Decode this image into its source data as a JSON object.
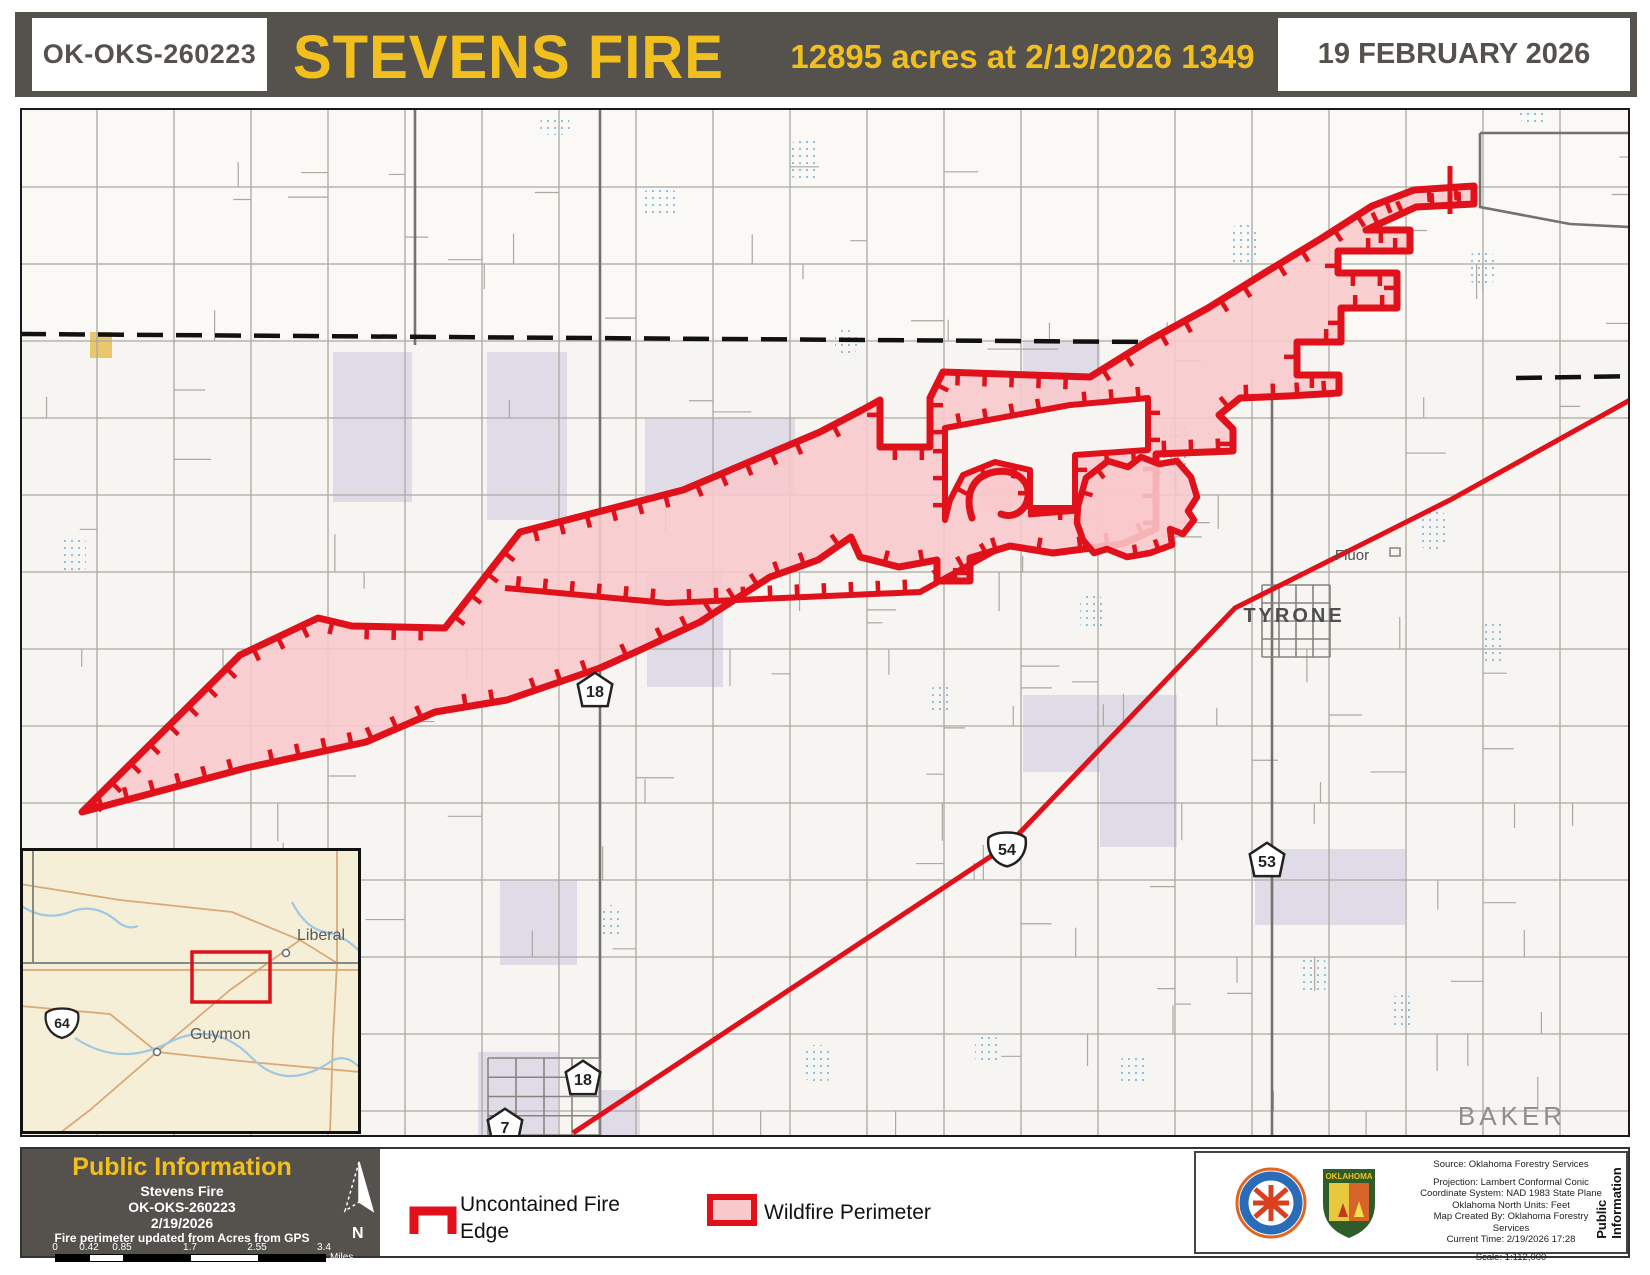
{
  "header": {
    "incident_id": "OK-OKS-260223",
    "title": "STEVENS FIRE",
    "acres_line": "12895 acres at 2/19/2026 1349",
    "date": "19 FEBRUARY 2026"
  },
  "colors": {
    "bar": "#55524E",
    "yellow": "#F2C01E",
    "fire_red": "#E0111A",
    "fire_pink": "#F8C8CB",
    "road": "#ABA8A2",
    "road_dark": "#75726E",
    "purple": "#CFCBE2",
    "water": "#6FB0D6",
    "inset_bg": "#F4EFD6",
    "tan": "#D9A977",
    "map_bg": "#F7F5F1",
    "kansas_bg": "#FAF9F6"
  },
  "map": {
    "labels": [
      {
        "text": "TYRONE",
        "x": 1294,
        "y": 622,
        "size": 20,
        "ls": 3,
        "color": "#4F4F4F",
        "bold": true
      },
      {
        "text": "Fluor",
        "x": 1352,
        "y": 560,
        "size": 15,
        "ls": 0,
        "color": "#4F4F4F",
        "bold": false
      },
      {
        "text": "BAKER",
        "x": 1512,
        "y": 1125,
        "size": 26,
        "ls": 4,
        "color": "#908E8A",
        "bold": false
      }
    ],
    "shields": [
      {
        "type": "state",
        "num": "18",
        "x": 595,
        "y": 690
      },
      {
        "type": "us",
        "num": "54",
        "x": 1007,
        "y": 848
      },
      {
        "type": "state",
        "num": "53",
        "x": 1267,
        "y": 860
      },
      {
        "type": "state",
        "num": "18",
        "x": 583,
        "y": 1078
      },
      {
        "type": "state",
        "num": "7",
        "x": 505,
        "y": 1126
      }
    ],
    "grid": {
      "vx": [
        97,
        174,
        251,
        328,
        405,
        482,
        559,
        636,
        713,
        790,
        867,
        944,
        1021,
        1098,
        1175,
        1252,
        1329,
        1406,
        1483,
        1560,
        1637
      ],
      "hy": [
        187,
        264,
        341,
        418,
        495,
        572,
        649,
        726,
        803,
        880,
        957,
        1034,
        1111
      ]
    },
    "dark_roads": [
      [
        [
          600,
          110
        ],
        [
          600,
          1135
        ]
      ],
      [
        [
          1272,
          380
        ],
        [
          1272,
          1135
        ]
      ],
      [
        [
          415,
          110
        ],
        [
          415,
          345
        ]
      ],
      [
        [
          1480,
          133
        ],
        [
          1648,
          133
        ]
      ],
      [
        [
          1480,
          133
        ],
        [
          1480,
          207
        ],
        [
          1570,
          224
        ],
        [
          1648,
          228
        ]
      ]
    ],
    "state_line": [
      [
        [
          20,
          334
        ],
        [
          1150,
          342
        ]
      ],
      [
        [
          1516,
          378
        ],
        [
          1642,
          376
        ]
      ]
    ],
    "purple_rects": [
      [
        333,
        352,
        79,
        150
      ],
      [
        487,
        352,
        80,
        168
      ],
      [
        645,
        418,
        150,
        76
      ],
      [
        647,
        572,
        76,
        115
      ],
      [
        1023,
        341,
        77,
        77
      ],
      [
        1023,
        695,
        154,
        77
      ],
      [
        1100,
        772,
        77,
        75
      ],
      [
        1255,
        849,
        150,
        76
      ],
      [
        500,
        880,
        77,
        85
      ],
      [
        478,
        1052,
        80,
        83
      ],
      [
        598,
        1090,
        42,
        45
      ]
    ],
    "yellow_rect": [
      90,
      332,
      22,
      26
    ],
    "water_spots": [
      [
        640,
        190,
        40,
        26
      ],
      [
        790,
        140,
        30,
        40
      ],
      [
        1230,
        225,
        26,
        40
      ],
      [
        540,
        115,
        30,
        20
      ],
      [
        1470,
        250,
        24,
        36
      ],
      [
        1520,
        105,
        26,
        20
      ],
      [
        60,
        535,
        26,
        40
      ],
      [
        1160,
        425,
        30,
        46
      ],
      [
        1420,
        510,
        26,
        40
      ],
      [
        1480,
        620,
        26,
        46
      ],
      [
        1080,
        595,
        24,
        36
      ],
      [
        930,
        685,
        22,
        30
      ],
      [
        255,
        950,
        24,
        40
      ],
      [
        600,
        905,
        22,
        34
      ],
      [
        805,
        1045,
        26,
        38
      ],
      [
        975,
        1035,
        24,
        30
      ],
      [
        1300,
        955,
        26,
        40
      ],
      [
        1390,
        995,
        24,
        34
      ],
      [
        1120,
        1055,
        26,
        30
      ],
      [
        835,
        330,
        22,
        26
      ]
    ],
    "highway54": [
      [
        1648,
        390
      ],
      [
        1450,
        500
      ],
      [
        1235,
        608
      ],
      [
        1008,
        845
      ],
      [
        573,
        1133
      ]
    ],
    "town_grids": [
      [
        1262,
        585,
        68,
        72
      ],
      [
        488,
        1058,
        112,
        77
      ]
    ],
    "fluor_site": [
      1390,
      548,
      10,
      8
    ],
    "fire": {
      "main": [
        [
          82,
          812
        ],
        [
          240,
          655
        ],
        [
          318,
          618
        ],
        [
          352,
          626
        ],
        [
          445,
          628
        ],
        [
          520,
          532
        ],
        [
          683,
          490
        ],
        [
          820,
          432
        ],
        [
          862,
          410
        ],
        [
          880,
          400
        ],
        [
          880,
          447
        ],
        [
          930,
          447
        ],
        [
          930,
          398
        ],
        [
          943,
          372
        ],
        [
          1090,
          377
        ],
        [
          1148,
          341
        ],
        [
          1208,
          308
        ],
        [
          1266,
          272
        ],
        [
          1322,
          238
        ],
        [
          1372,
          206
        ],
        [
          1414,
          190
        ],
        [
          1474,
          186
        ],
        [
          1474,
          204
        ],
        [
          1416,
          207
        ],
        [
          1366,
          230
        ],
        [
          1410,
          230
        ],
        [
          1410,
          251
        ],
        [
          1338,
          251
        ],
        [
          1338,
          273
        ],
        [
          1397,
          273
        ],
        [
          1397,
          308
        ],
        [
          1341,
          308
        ],
        [
          1341,
          342
        ],
        [
          1297,
          342
        ],
        [
          1297,
          375
        ],
        [
          1339,
          375
        ],
        [
          1339,
          393
        ],
        [
          1288,
          396
        ],
        [
          1240,
          398
        ],
        [
          1219,
          415
        ],
        [
          1233,
          429
        ],
        [
          1233,
          451
        ],
        [
          1156,
          454
        ],
        [
          1156,
          529
        ],
        [
          1122,
          544
        ],
        [
          1053,
          553
        ],
        [
          1010,
          546
        ],
        [
          970,
          558
        ],
        [
          970,
          581
        ],
        [
          937,
          581
        ],
        [
          937,
          560
        ],
        [
          899,
          567
        ],
        [
          860,
          557
        ],
        [
          851,
          537
        ],
        [
          818,
          560
        ],
        [
          770,
          577
        ],
        [
          700,
          622
        ],
        [
          640,
          650
        ],
        [
          600,
          668
        ],
        [
          507,
          700
        ],
        [
          435,
          712
        ],
        [
          366,
          742
        ],
        [
          246,
          768
        ]
      ],
      "notch": [
        [
          945,
          428
        ],
        [
          1070,
          405
        ],
        [
          1148,
          398
        ],
        [
          1148,
          450
        ],
        [
          1075,
          455
        ],
        [
          1075,
          508
        ],
        [
          1030,
          508
        ],
        [
          1030,
          470
        ],
        [
          995,
          462
        ],
        [
          963,
          475
        ],
        [
          950,
          500
        ],
        [
          945,
          520
        ]
      ],
      "east_blob": [
        [
          1078,
          506
        ],
        [
          1086,
          478
        ],
        [
          1108,
          461
        ],
        [
          1128,
          467
        ],
        [
          1141,
          457
        ],
        [
          1159,
          464
        ],
        [
          1177,
          461
        ],
        [
          1191,
          477
        ],
        [
          1197,
          497
        ],
        [
          1188,
          511
        ],
        [
          1194,
          520
        ],
        [
          1183,
          534
        ],
        [
          1170,
          529
        ],
        [
          1172,
          545
        ],
        [
          1150,
          553
        ],
        [
          1127,
          557
        ],
        [
          1107,
          549
        ],
        [
          1094,
          553
        ],
        [
          1083,
          540
        ],
        [
          1077,
          523
        ]
      ],
      "inner_line": [
        [
          1000,
          548
        ],
        [
          920,
          592
        ],
        [
          667,
          603
        ],
        [
          505,
          588
        ]
      ],
      "hook_path": "M 972,518 C 964,494 973,476 994,472 C 1016,468 1030,481 1028,497 C 1026,511 1013,519 1001,514",
      "hook_center": [
        998,
        495
      ],
      "connector": [
        [
          1028,
          514
        ],
        [
          1078,
          510
        ]
      ],
      "tip_cross": [
        [
          1450,
          166
        ],
        [
          1450,
          214
        ]
      ]
    }
  },
  "inset": {
    "towns": [
      {
        "name": "Liberal",
        "x": 286,
        "y": 953,
        "lx": 297,
        "ly": 940
      },
      {
        "name": "Guymon",
        "x": 157,
        "y": 1052,
        "lx": 190,
        "ly": 1039
      }
    ],
    "shield": {
      "num": "64",
      "x": 62,
      "y": 1022
    },
    "extent_rect": [
      192,
      952,
      78,
      50
    ],
    "rivers": [
      "M 20,905 Q 45,922 70,912 Q 95,902 118,922 Q 128,930 138,926",
      "M 292,902 Q 305,928 325,932 Q 345,936 358,950",
      "M 75,1038 Q 120,1068 170,1042 Q 215,1020 252,1058 Q 285,1092 330,1062 Q 345,1052 360,1068"
    ],
    "tan_roads": [
      [
        [
          20,
          884
        ],
        [
          120,
          900
        ],
        [
          232,
          912
        ],
        [
          300,
          940
        ],
        [
          337,
          963
        ]
      ],
      [
        [
          300,
          940
        ],
        [
          230,
          990
        ],
        [
          157,
          1052
        ],
        [
          90,
          1110
        ],
        [
          60,
          1133
        ]
      ],
      [
        [
          20,
          1006
        ],
        [
          110,
          1014
        ],
        [
          157,
          1052
        ],
        [
          250,
          1062
        ],
        [
          360,
          1072
        ]
      ],
      [
        [
          337,
          848
        ],
        [
          337,
          963
        ],
        [
          333,
          1040
        ],
        [
          330,
          1133
        ]
      ],
      [
        [
          20,
          970
        ],
        [
          360,
          970
        ]
      ]
    ],
    "state_lines": [
      [
        [
          20,
          963
        ],
        [
          360,
          963
        ]
      ],
      [
        [
          33,
          848
        ],
        [
          33,
          963
        ]
      ]
    ]
  },
  "legend": {
    "public_info": "Public Information",
    "fire_name": "Stevens Fire",
    "incident": "OK-OKS-260223",
    "date": "2/19/2026",
    "update_note": "Fire perimeter updated from Acres from GPS",
    "scale_labels": [
      "0",
      "0.42",
      "0.85",
      "1.7",
      "2.55",
      "3.4"
    ],
    "miles": "Miles",
    "north": "N",
    "item1_line1": "Uncontained Fire",
    "item1_line2": "Edge",
    "item2": "Wildfire Perimeter"
  },
  "credits": {
    "lines": [
      "Source: Oklahoma Forestry Services",
      "",
      "Projection: Lambert Conformal Conic",
      "Coordinate System: NAD 1983 State Plane",
      "Oklahoma North Units: Feet",
      "Map Created By: Oklahoma Forestry Services",
      "Current Time: 2/19/2026 17:28",
      "",
      "Scale: 1:112,000"
    ],
    "vertical": "Public Information",
    "logo1": "fire-management-seal",
    "logo2": "oklahoma-forestry-shield"
  }
}
